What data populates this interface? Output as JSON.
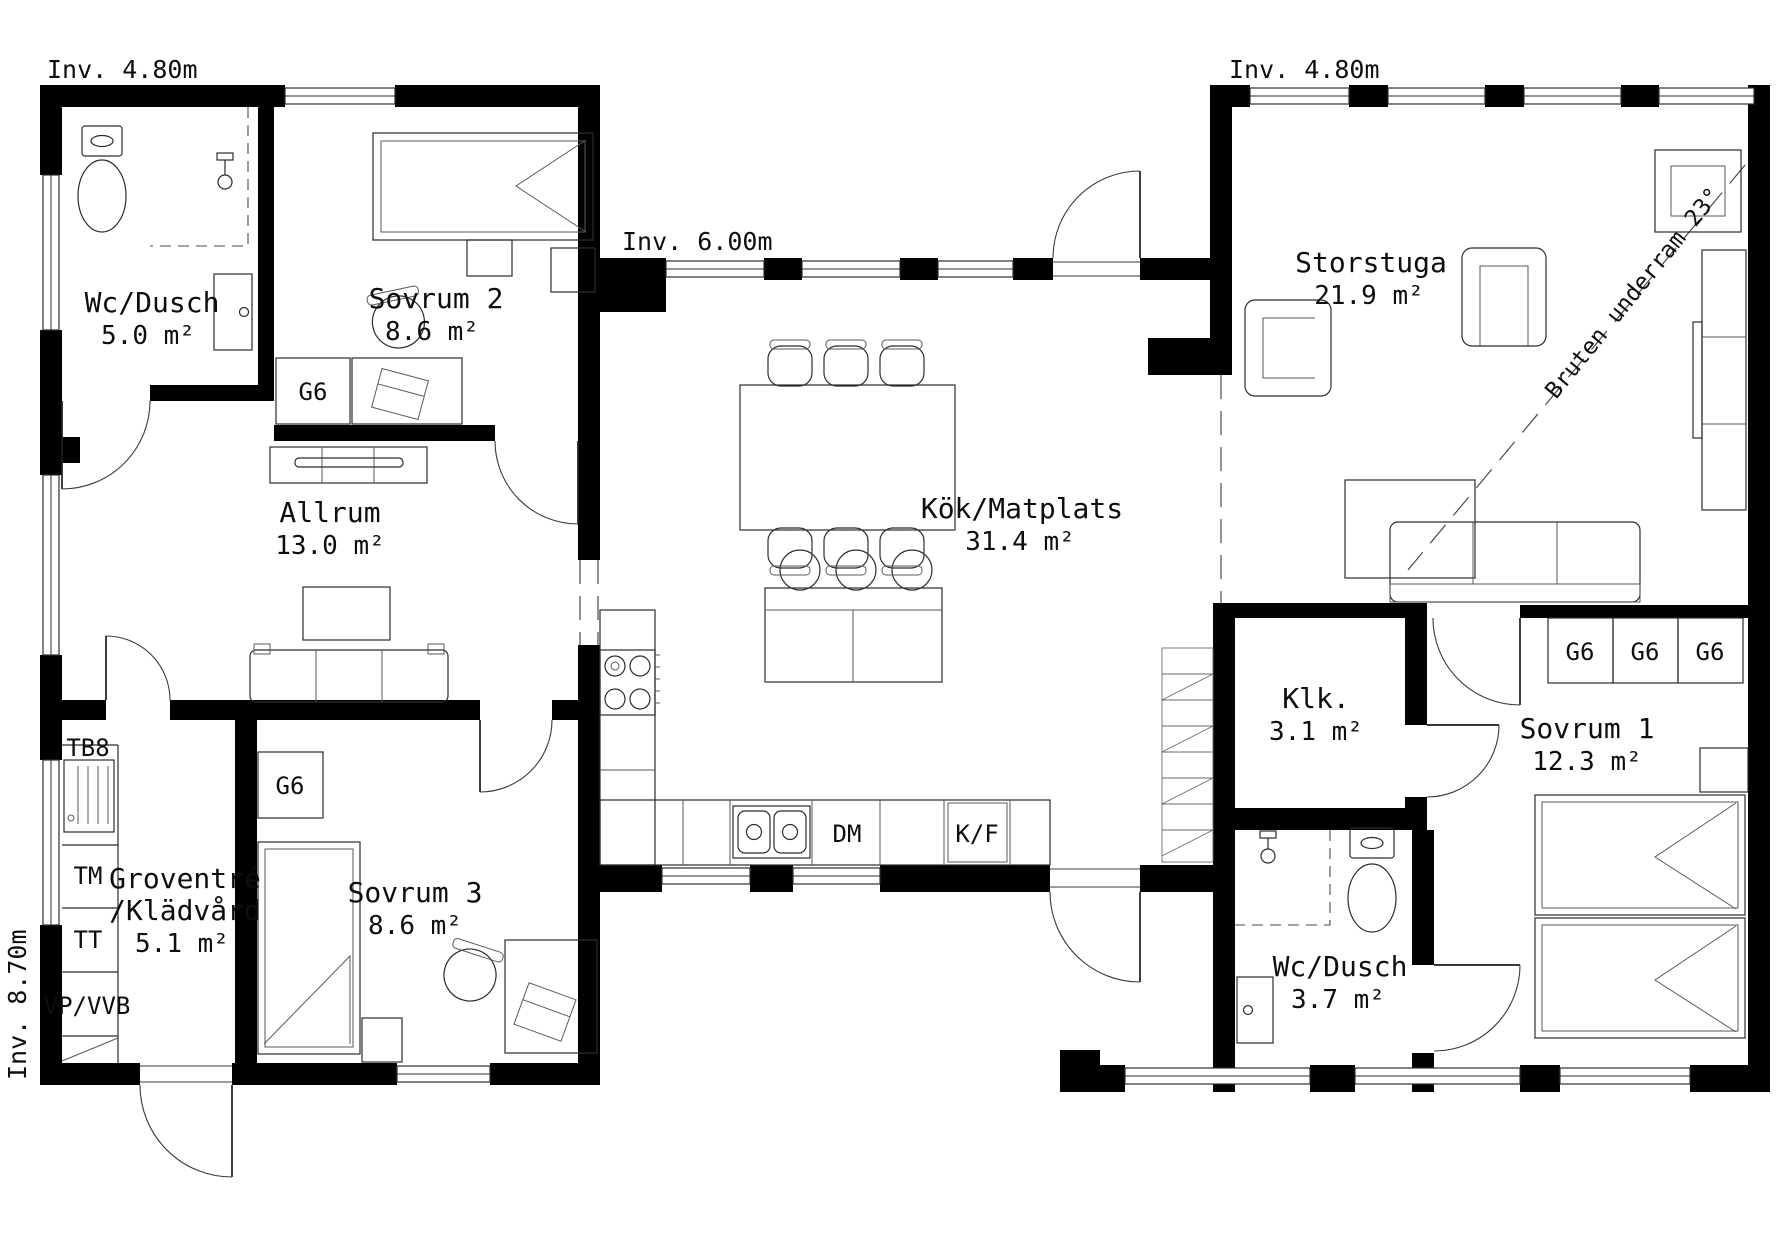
{
  "plan": {
    "dims": {
      "top_left": "Inv. 4.80m",
      "top_mid": "Inv. 6.00m",
      "top_right": "Inv. 4.80m",
      "left": "Inv. 8.70m"
    },
    "note": "Bruten underram 23°",
    "rooms": {
      "wc1": {
        "name": "Wc/Dusch",
        "area": "5.0 m²"
      },
      "sov2": {
        "name": "Sovrum 2",
        "area": "8.6 m²"
      },
      "allrum": {
        "name": "Allrum",
        "area": "13.0 m²"
      },
      "kok": {
        "name": "Kök/Matplats",
        "area": "31.4 m²"
      },
      "storstuga": {
        "name": "Storstuga",
        "area": "21.9 m²"
      },
      "grov": {
        "l1": "Groventré",
        "l2": "/Klädvård",
        "area": "5.1 m²"
      },
      "sov3": {
        "name": "Sovrum 3",
        "area": "8.6 m²"
      },
      "klk": {
        "name": "Klk.",
        "area": "3.1 m²"
      },
      "sov1": {
        "name": "Sovrum 1",
        "area": "12.3 m²"
      },
      "wc2": {
        "name": "Wc/Dusch",
        "area": "3.7 m²"
      }
    },
    "fixtures": {
      "wardrobe": "G6",
      "bench": "TB8",
      "washer": "TM",
      "dryer": "TT",
      "heater": "VP/VVB",
      "dishwasher": "DM",
      "fridge": "K/F"
    },
    "colors": {
      "wall": "#000000",
      "line": "#2c2c2c",
      "background": "#ffffff"
    }
  }
}
